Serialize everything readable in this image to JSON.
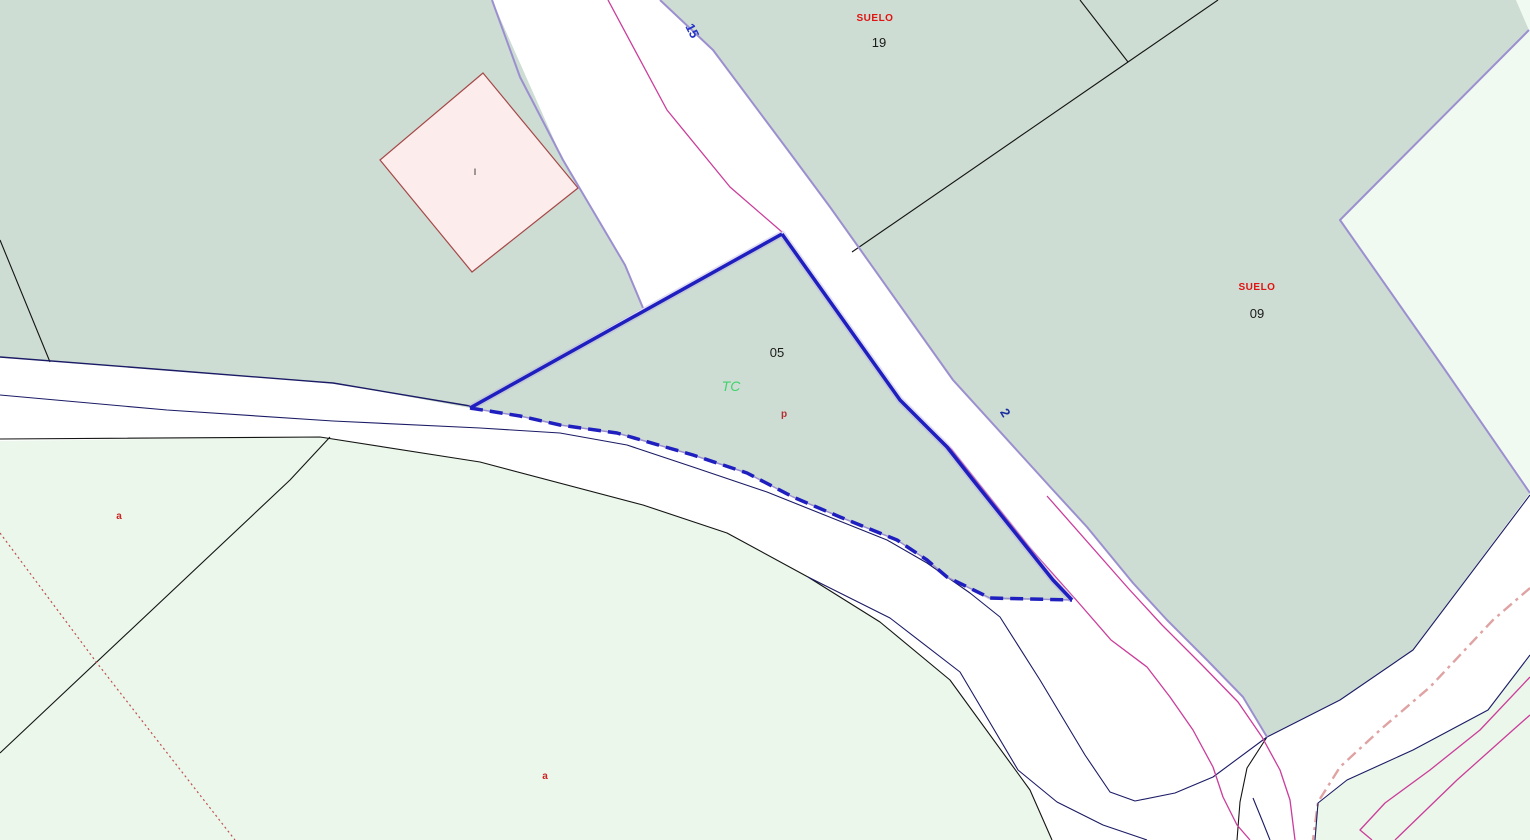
{
  "map": {
    "labels": {
      "road_top": "15",
      "road_right": "2",
      "suelo_19_title": "SUELO",
      "suelo_19_number": "19",
      "suelo_09_title": "SUELO",
      "suelo_09_number": "09",
      "parcel_05_number": "05",
      "parcel_05_use": "TC",
      "parcel_05_sub": "p",
      "subparcel_left": "a",
      "subparcel_bottom": "a",
      "construction_mark": "I"
    },
    "colors": {
      "background": "#ffffff",
      "parcel_sage": "#cdddd3",
      "parcel_light_green": "#eaf7ea",
      "parcel_light_green_ne": "#f1faf1",
      "construction_pink_fill": "#fdecec",
      "construction_pink_border": "#a54848",
      "selection_blue": "#1f1fbf",
      "selection_halo": "#b3abe2",
      "road_edge_purple": "#9c8fd0",
      "boundary_magenta": "#cb3d9b",
      "boundary_navy": "#1b1b66",
      "boundary_black": "#141414",
      "boundary_red_dotted": "#c05050",
      "boundary_pink_dashdot": "#dfa3a3",
      "label_red": "#e01212",
      "label_black": "#1a1a1a",
      "label_green": "#3fd46a",
      "label_dark_red": "#b03030",
      "label_blue": "#2433c9",
      "label_navy": "#1d2f9e"
    }
  }
}
